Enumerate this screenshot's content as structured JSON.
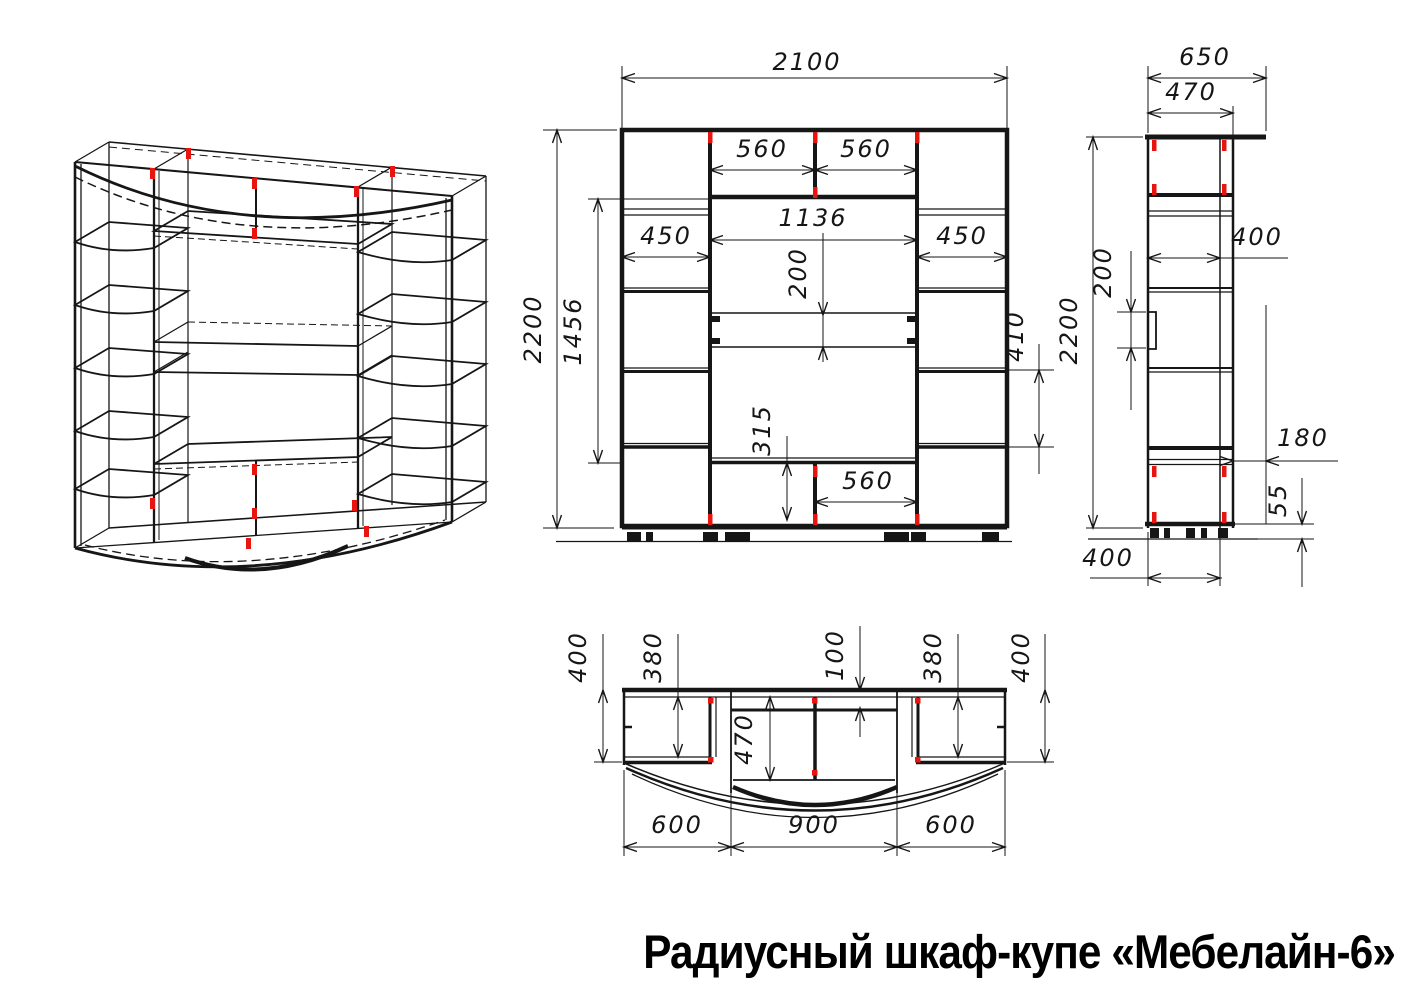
{
  "title": "Радиусный шкаф-купе «Мебелайн-6»",
  "colors": {
    "line": "#161616",
    "connector_red": "#e81410",
    "background": "#ffffff"
  },
  "views": {
    "isometric": {
      "label": "isometric wireframe view"
    },
    "front": {
      "label": "front view",
      "dims": {
        "total_width": "2100",
        "total_height": "2200",
        "opening_height": "1456",
        "top_shelf_left": "560",
        "top_shelf_right": "560",
        "middle_width": "1136",
        "left_column_width": "450",
        "right_column_width": "450",
        "drawer_band_height": "200",
        "right_shelf_spacing": "410",
        "bottom_section_height": "315",
        "bottom_shelf_width": "560"
      }
    },
    "side": {
      "label": "side view",
      "dims": {
        "total_depth": "650",
        "body_depth": "470",
        "total_height": "2200",
        "shelf_depth": "400",
        "drawer_band_height": "200",
        "top_overhang": "180",
        "plinth_height": "55",
        "base_depth": "400"
      }
    },
    "plan": {
      "label": "top plan view",
      "dims": {
        "side_depth_left": "400",
        "shelf_depth_left": "380",
        "center_setback": "100",
        "shelf_depth_right": "380",
        "side_depth_right": "400",
        "center_depth": "470",
        "section_width_left": "600",
        "section_width_center": "900",
        "section_width_right": "600"
      }
    }
  }
}
